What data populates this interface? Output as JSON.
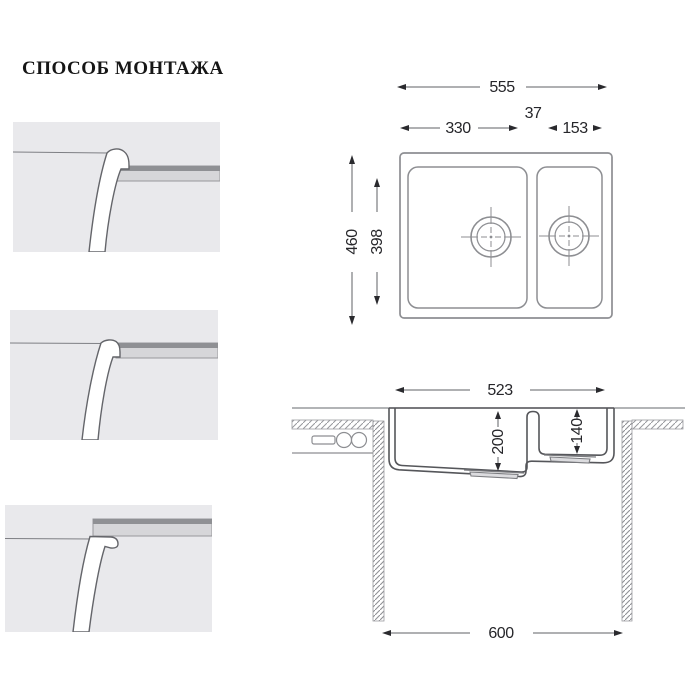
{
  "title": {
    "text": "СПОСОБ МОНТАЖА"
  },
  "colors": {
    "panel_bg": "#e9e9ec",
    "counter_edge_dark": "#8f9094",
    "counter_body": "#d6d6d9",
    "drawing_line": "#85868a",
    "section_line": "#55565a",
    "dimension_text": "#26262a"
  },
  "mount_panels": [
    {
      "name": "top-mount-detail"
    },
    {
      "name": "flush-mount-detail"
    },
    {
      "name": "under-mount-detail"
    }
  ],
  "top_view": {
    "total_width": "555",
    "bowl1_width": "330",
    "divider_width": "37",
    "bowl2_width": "153",
    "total_depth": "460",
    "bowl_depth": "398"
  },
  "section_view": {
    "rim_width": "523",
    "bowl1_depth": "200",
    "bowl2_depth": "140",
    "cabinet_width": "600"
  }
}
